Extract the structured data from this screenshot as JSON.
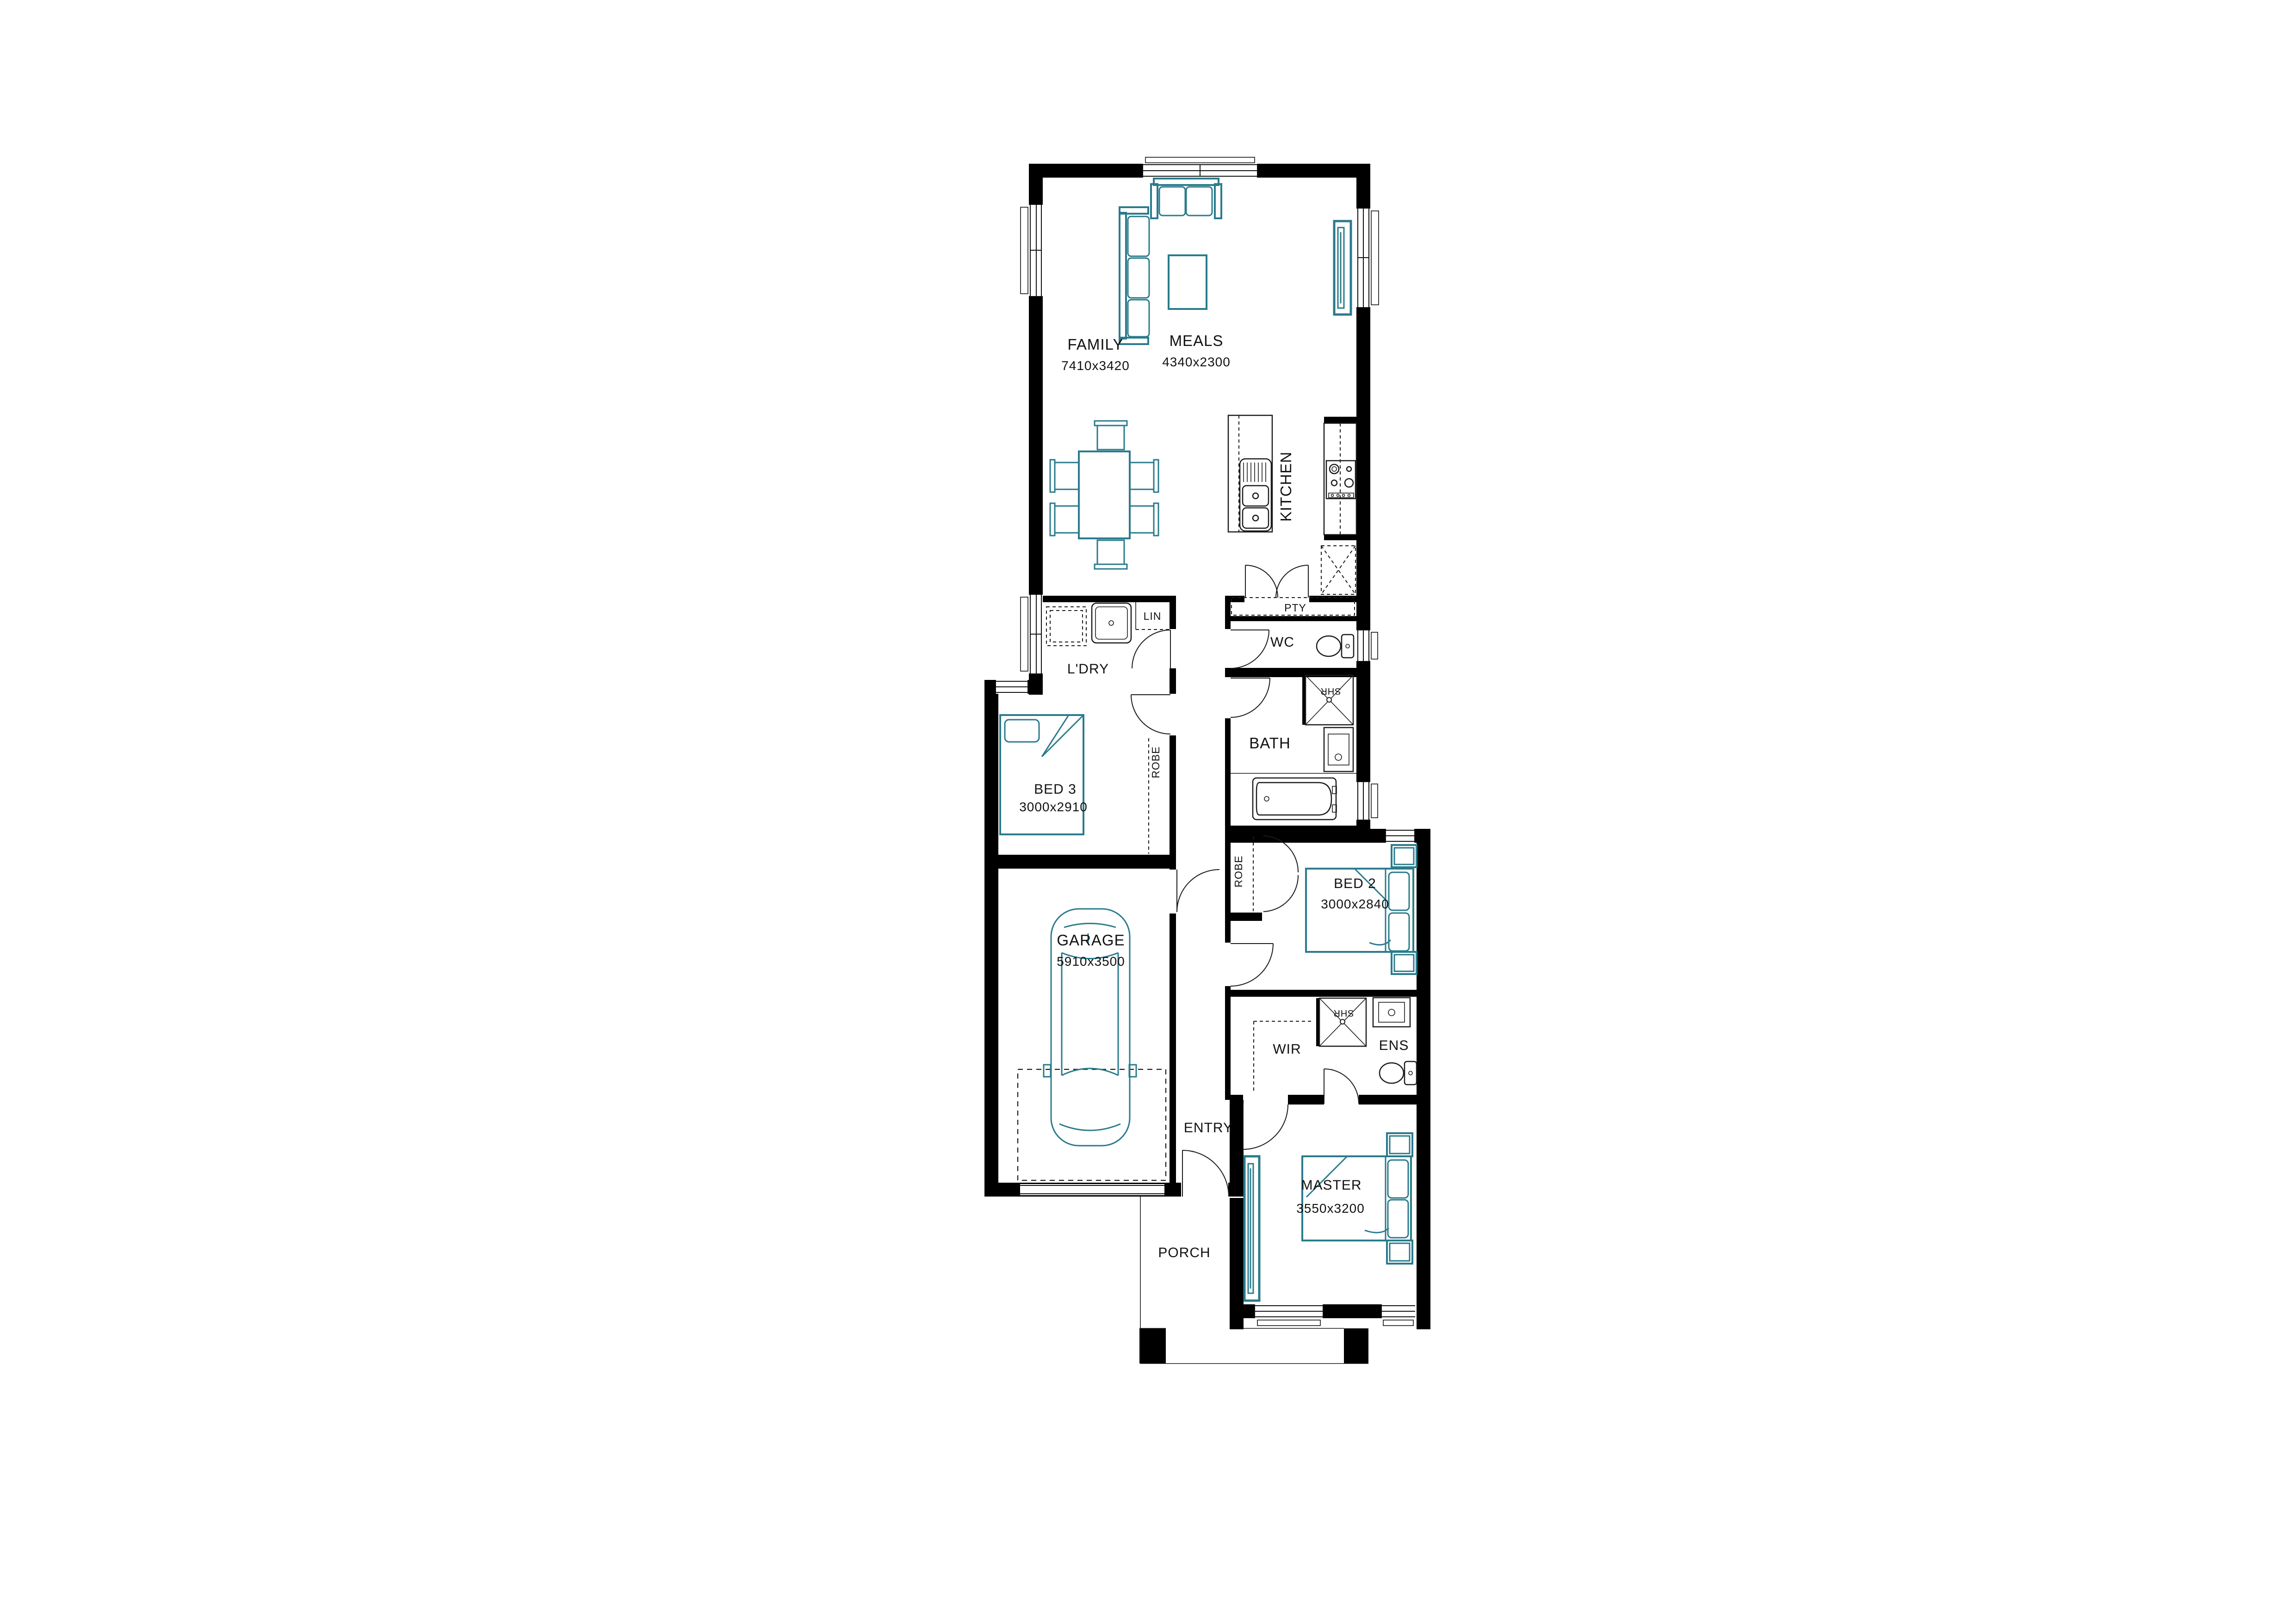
{
  "plan": {
    "colors": {
      "wall": "#000000",
      "furniture": "#2a7b8c",
      "background": "#ffffff",
      "text": "#111111"
    },
    "rooms": {
      "family": {
        "label": "FAMILY",
        "dims": "7410x3420"
      },
      "meals": {
        "label": "MEALS",
        "dims": "4340x2300"
      },
      "kitchen": {
        "label": "KITCHEN"
      },
      "pantry": {
        "label": "PTY"
      },
      "laundry": {
        "label": "L'DRY"
      },
      "linen": {
        "label": "LIN"
      },
      "wc": {
        "label": "WC"
      },
      "bath": {
        "label": "BATH"
      },
      "shr_bath": {
        "label": "SHR"
      },
      "bed3": {
        "label": "BED 3",
        "dims": "3000x2910"
      },
      "robe3": {
        "label": "ROBE"
      },
      "garage": {
        "label": "GARAGE",
        "dims": "5910x3500"
      },
      "entry": {
        "label": "ENTRY"
      },
      "bed2": {
        "label": "BED 2",
        "dims": "3000x2840"
      },
      "robe2": {
        "label": "ROBE"
      },
      "wir": {
        "label": "WIR"
      },
      "shr_ens": {
        "label": "SHR"
      },
      "ens": {
        "label": "ENS"
      },
      "master": {
        "label": "MASTER",
        "dims": "3550x3200"
      },
      "porch": {
        "label": "PORCH"
      }
    }
  }
}
